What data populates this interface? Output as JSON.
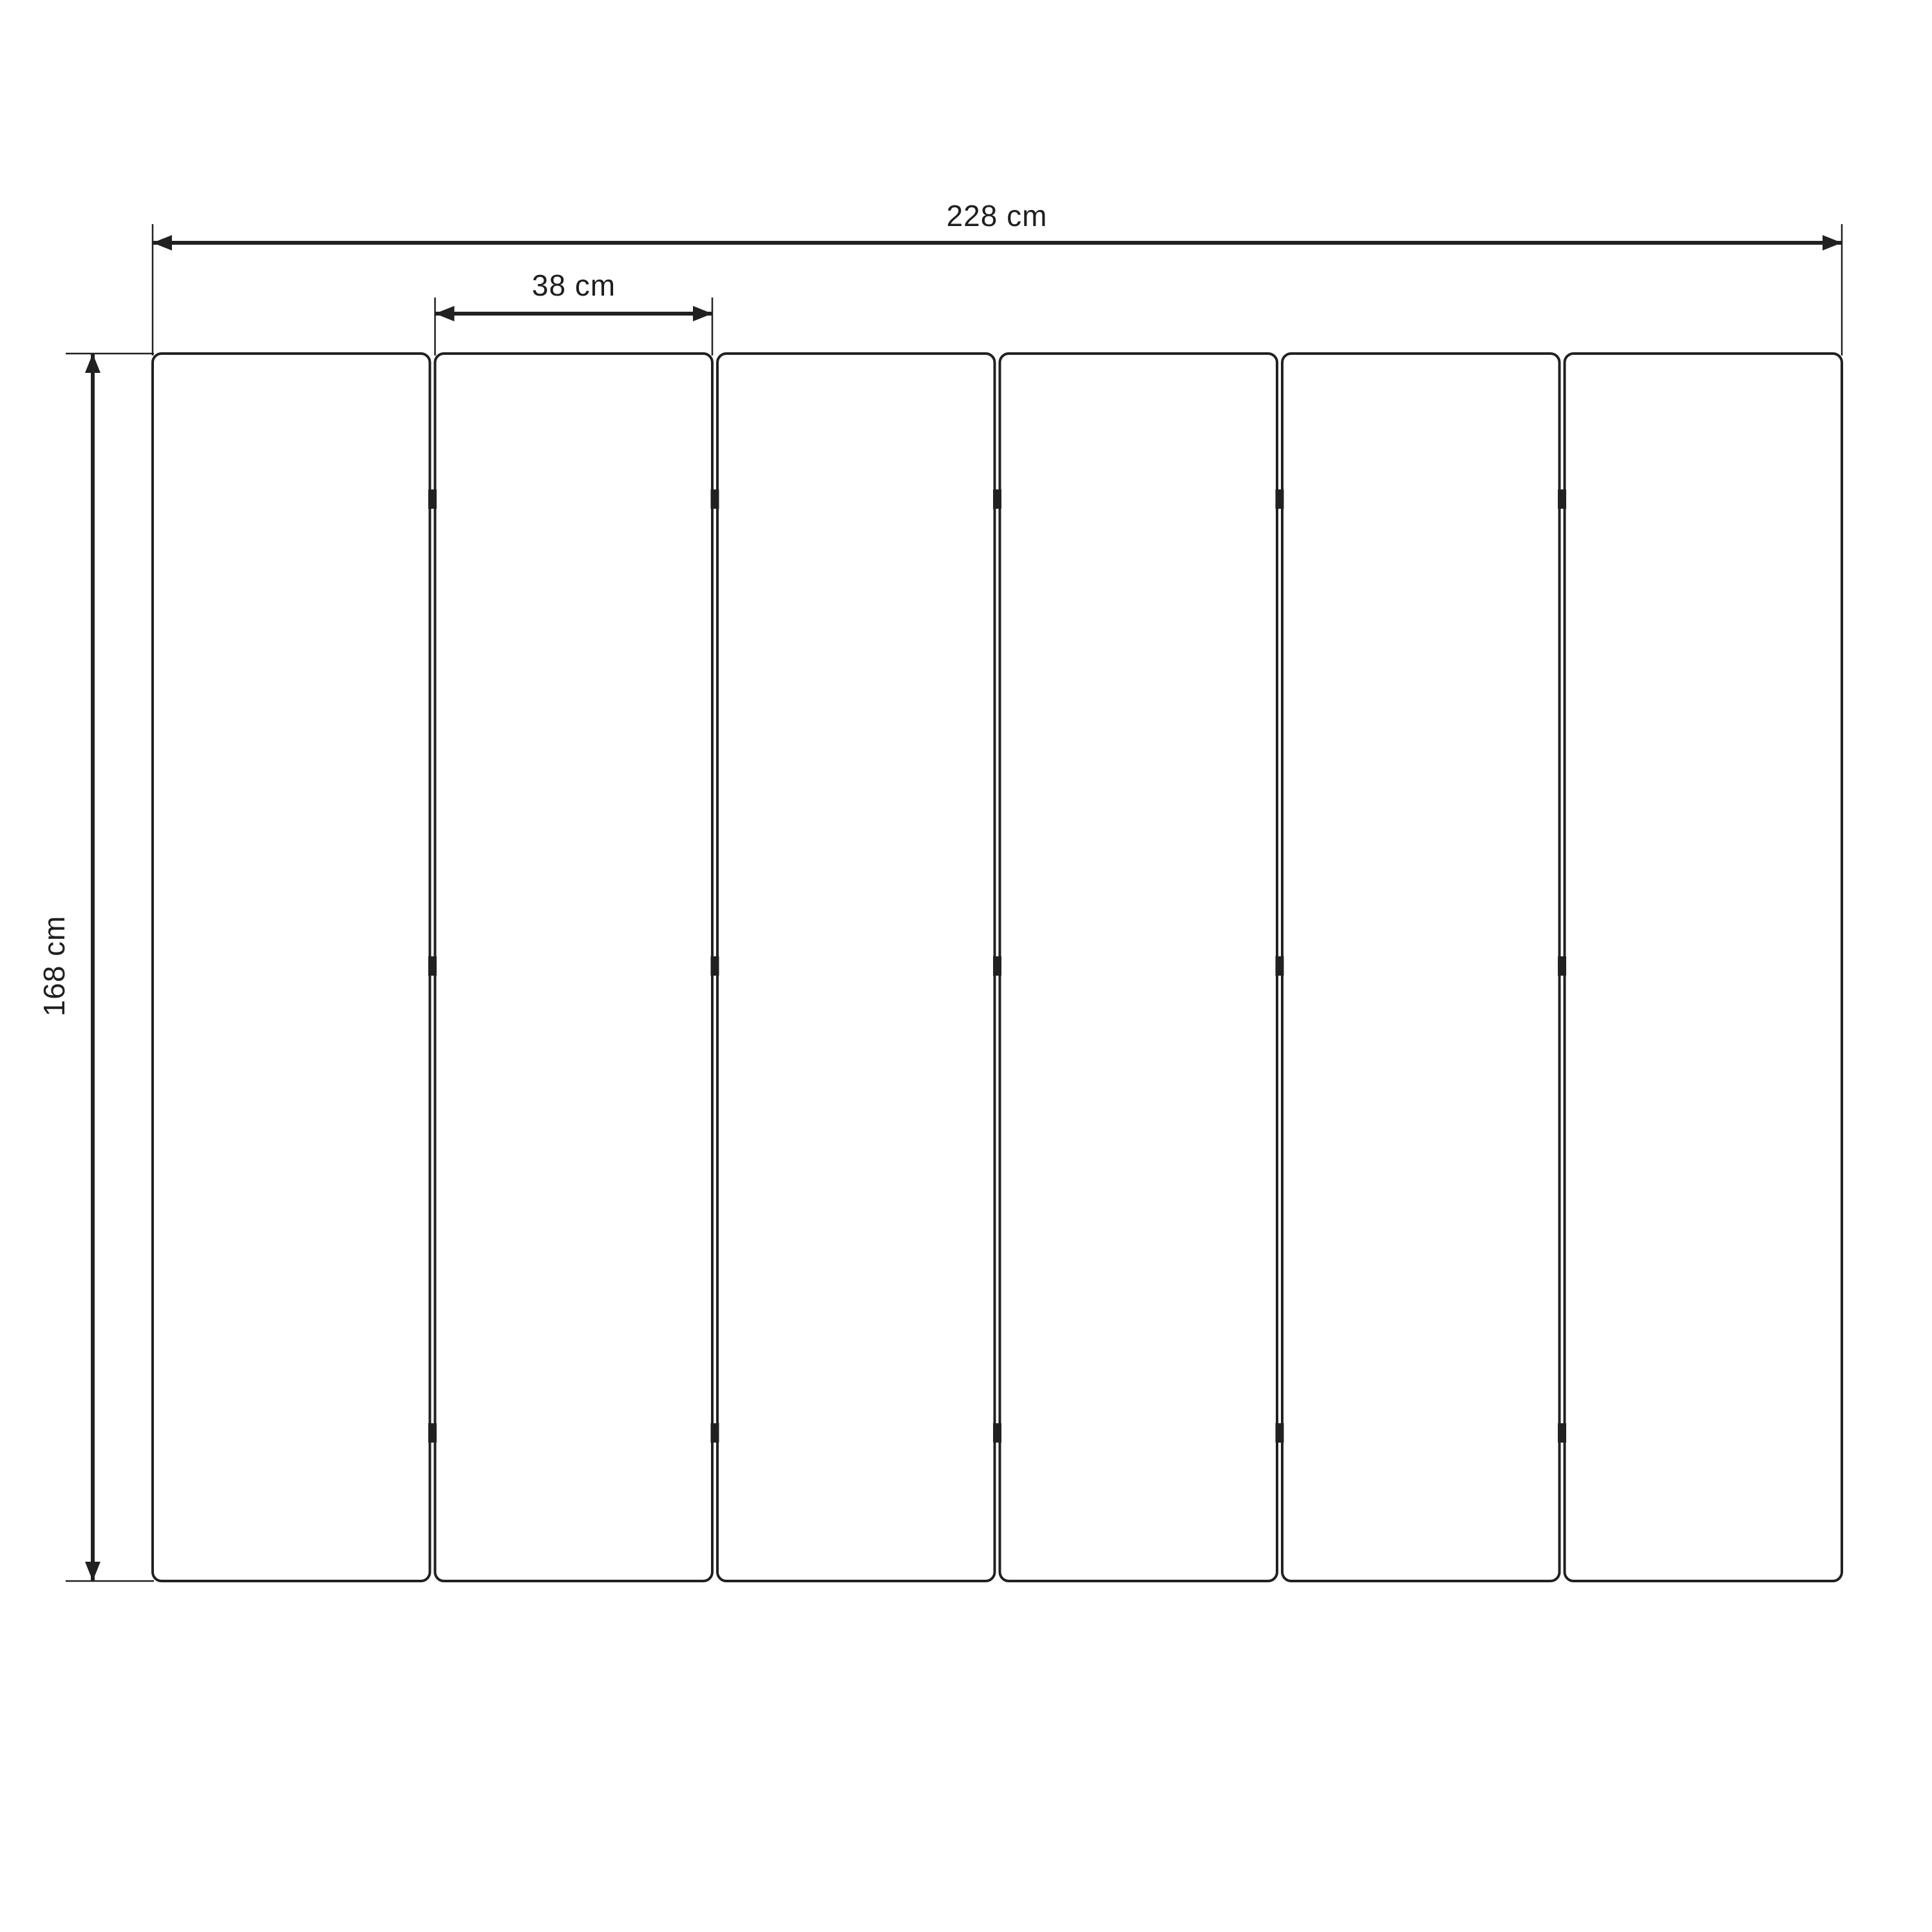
{
  "diagram": {
    "background_color": "#ffffff",
    "line_color": "#212121",
    "text_color": "#1f1f1f",
    "panel_count": 6,
    "gap_count": 5,
    "hinge_rows_per_gap": 3,
    "labels": {
      "total_width": "228 cm",
      "panel_width": "38 cm",
      "panel_height": "168 cm"
    }
  }
}
